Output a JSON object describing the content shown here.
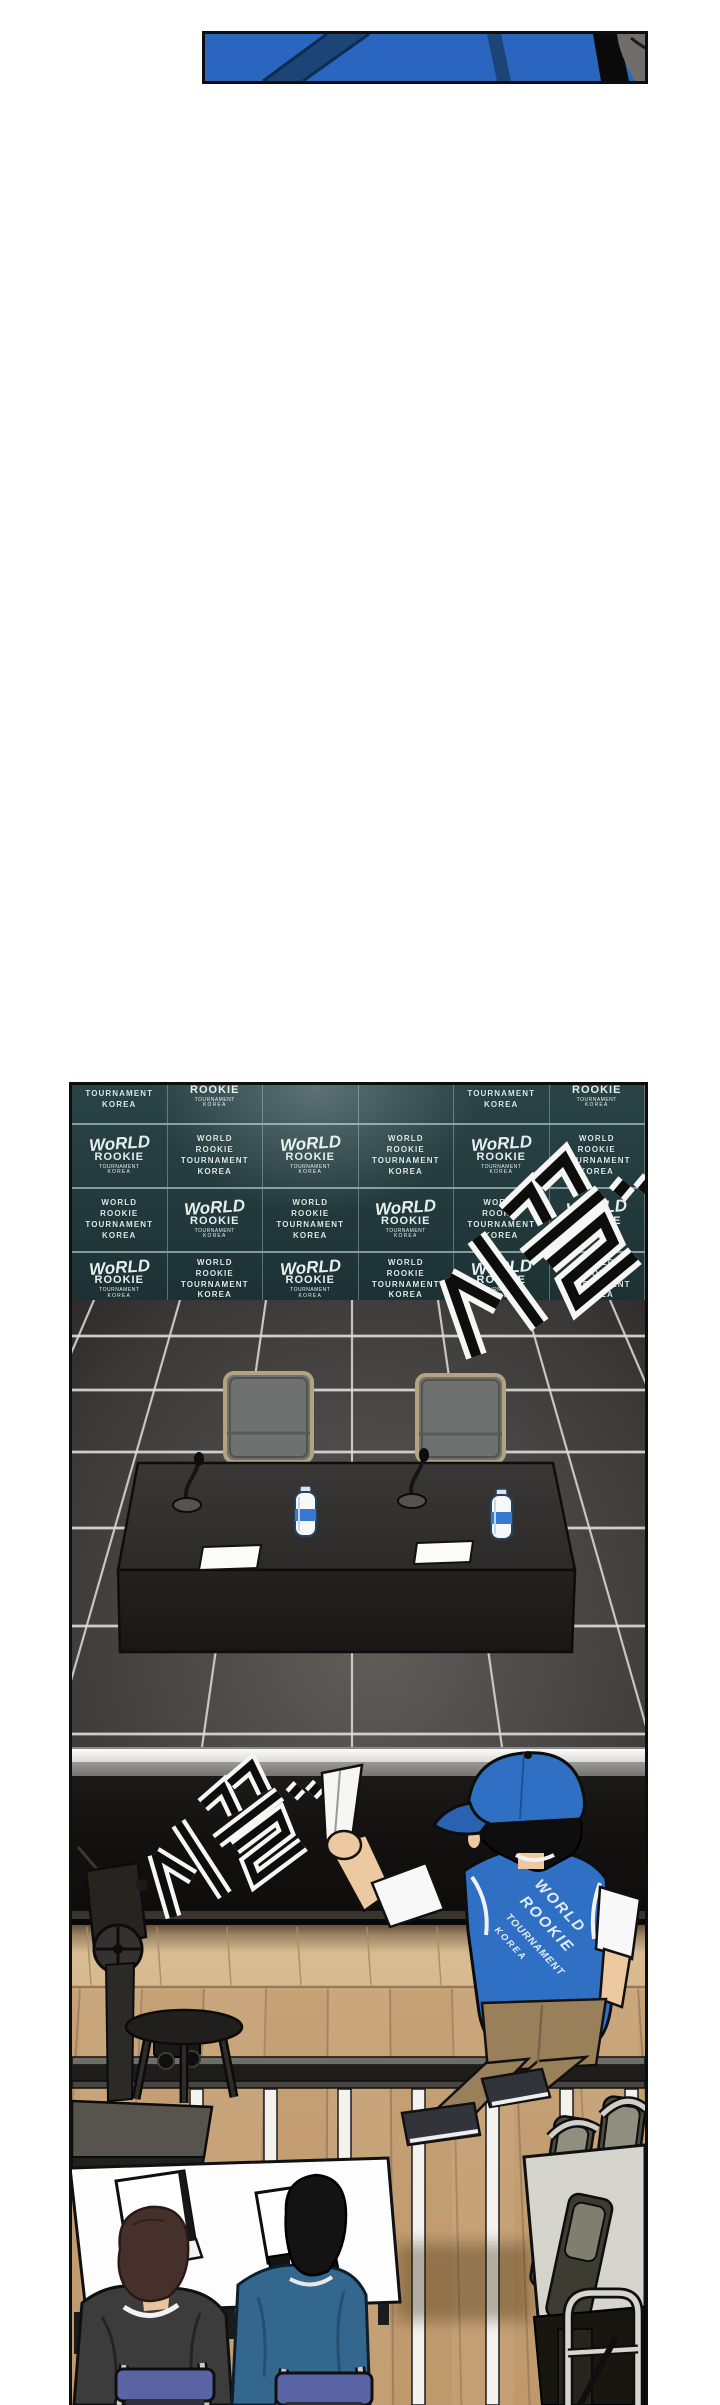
{
  "page": {
    "width": 720,
    "height": 2405,
    "background": "#ffffff"
  },
  "top_strip_panel": {
    "colors": {
      "jacket_blue": "#2a66bf",
      "strap_navy": "#1d4476",
      "hood_gray": "#6f6e6c",
      "outline": "#0d0d0d"
    }
  },
  "press_room_panel": {
    "wall": {
      "background": "#233a3d",
      "seam_color": "#c8d8d8",
      "logo_color": "#e7efee",
      "mark_logo": {
        "line1": "WoRLD",
        "line2": "ROOKIE",
        "line3": "TOURNAMENT",
        "line4": "KOREA"
      },
      "text_logo": {
        "lines": [
          "WORLD",
          "ROOKIE",
          "TOURNAMENT",
          "KOREA"
        ]
      },
      "rows": [
        {
          "cells": [
            "text",
            "mark",
            "none",
            "none",
            "text",
            "mark"
          ]
        },
        {
          "cells": [
            "mark",
            "text",
            "mark",
            "text",
            "mark",
            "text"
          ]
        },
        {
          "cells": [
            "text",
            "mark",
            "text",
            "mark",
            "text",
            "mark"
          ]
        },
        {
          "cells": [
            "mark",
            "text",
            "mark",
            "text",
            "mark",
            "text"
          ]
        }
      ]
    },
    "sound_effect": {
      "text": "시끌.."
    },
    "floor": {
      "tile_color": "#4b4947",
      "grout_color": "#dedddb"
    },
    "furniture": {
      "table_color": "#262423",
      "chair_fill": "#6f7170",
      "chair_frame": "#b5a27f",
      "bottle_label": "#3779d0",
      "paper_color": "#fbfbf9"
    }
  },
  "backstage_panel": {
    "sound_effect": {
      "text": "시끌.."
    },
    "stage_color": "#141210",
    "stage_edge_color": "#f4f4f2",
    "wood_floor_color": "#c6a176",
    "tape_color": "#f3f2ee",
    "staff": {
      "cap_color": "#2f6fc4",
      "vest_color": "#2f6fc4",
      "vest_back_text": [
        "WORLD",
        "ROOKIE",
        "TOURNAMENT",
        "KOREA"
      ],
      "pants_color": "#99805b",
      "paper_color": "#f6f6f4"
    }
  },
  "press_seats_area": {
    "desk_color": "#fdfdfd",
    "laptop_screen_color": "#ffffff",
    "reporter_left": {
      "hair": "#46302b",
      "jacket": "#3d3c3c"
    },
    "reporter_right": {
      "hair": "#131313",
      "jacket": "#34678d"
    },
    "chair_pad_color": "#5a64a4",
    "stacked_chairs": {
      "table": "#d5d5cd",
      "pad": "#4c4c41",
      "frame": "#d0d0c8"
    }
  }
}
